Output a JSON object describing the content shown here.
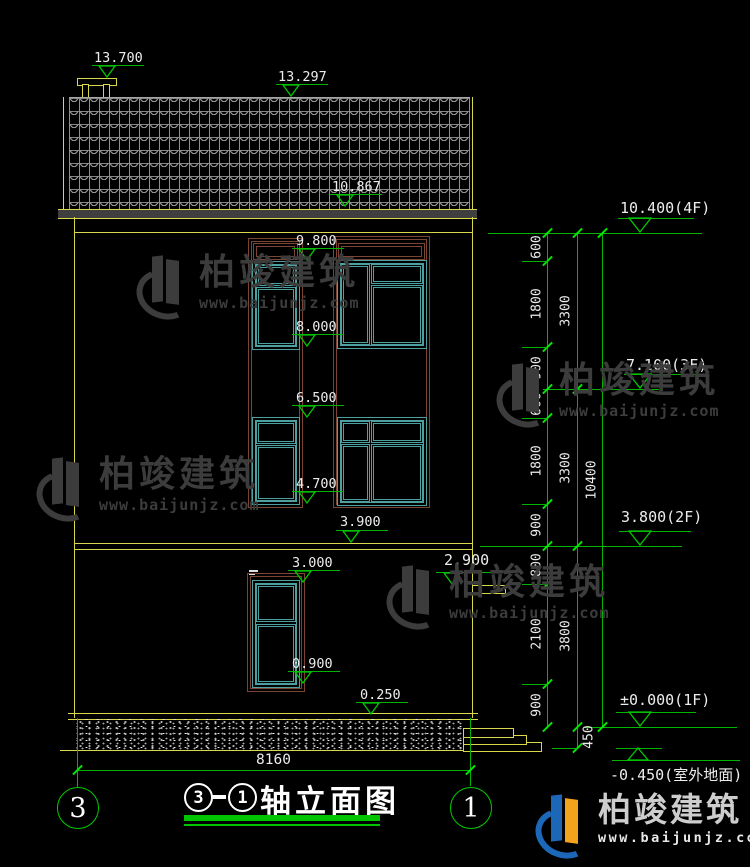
{
  "title": {
    "circle_left": "3",
    "circle_right": "1",
    "text": "轴立面图"
  },
  "axis_bubbles": {
    "left": "3",
    "right": "1"
  },
  "elev": {
    "chimney": "13.700",
    "ridge": "13.297",
    "eave": "10.867",
    "w3top": "9.800",
    "w3bot": "8.000",
    "w2top": "6.500",
    "w2bot": "4.700",
    "band": "3.900",
    "w1top": "3.000",
    "canopy": "2.900",
    "w1bot": "0.900",
    "plinth": "0.250"
  },
  "floors": {
    "f4": "10.400(4F)",
    "f3": "7.100(3F)",
    "f2": "3.800(2F)",
    "f1": "±0.000(1F)",
    "ground": "-0.450(室外地面)"
  },
  "dims": {
    "inner": [
      "600",
      "1800",
      "900",
      "600",
      "1800",
      "900",
      "800",
      "2100",
      "900"
    ],
    "middle": [
      "3300",
      "3300",
      "3800",
      "450"
    ],
    "overall": "10400",
    "width": "8160"
  },
  "watermark": {
    "brand": "柏竣建筑",
    "url": "www.baijunjz.com"
  },
  "logo": {
    "brand": "柏竣建筑",
    "url": "www.baijunjz.com"
  },
  "colors": {
    "line_green": "#00b400",
    "line_yellow": "#d8d848",
    "frame_brown": "#7c4433",
    "frame_teal": "#4da0a0",
    "text_white": "#ececec",
    "logo_blue": "#1c67b8",
    "logo_orange": "#f2a21c"
  }
}
